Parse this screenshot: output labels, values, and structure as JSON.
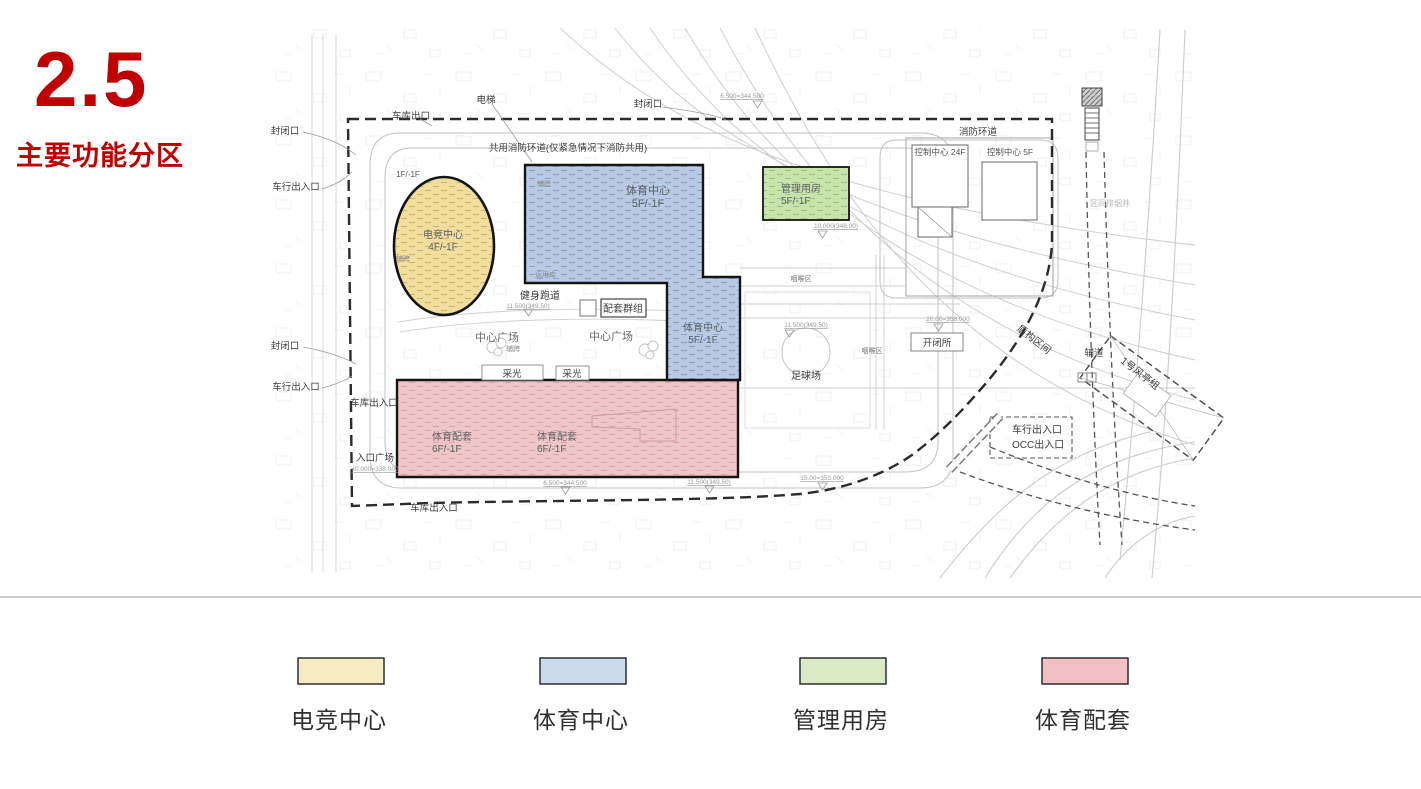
{
  "slide": {
    "number": "2.5",
    "title": "主要功能分区",
    "accent_color": "#C00000"
  },
  "plan": {
    "labels": {
      "garage_exit": "车库出口",
      "elevator": "电梯",
      "closed_opening": "封闭口",
      "shared_fire_ring": "共用消防环道(仅紧急情况下消防共用)",
      "floors_1f": "1F/-1F",
      "vehicle_entrance": "车行出入口",
      "garage_entrance": "车库出入口",
      "entrance_plaza": "入口广场",
      "fire_ring": "消防环道",
      "control_center_24f": "控制中心  24F",
      "control_center_5f": "控制中心  5F",
      "fitness_track": "健身跑道",
      "support_cluster": "配套群组",
      "central_plaza": "中心广场",
      "aux_span": "辅跨",
      "operation_depot": "运用库",
      "daylight": "采光",
      "football_field": "足球场",
      "throat_area": "咽喉区",
      "switch_station": "开闭所",
      "shield_section": "盾构区间",
      "aux_road": "辅道",
      "wind_pavilion": "1号风亭组",
      "occ_entrance": "OCC出入口",
      "smoke_shaft": "区间排烟井"
    },
    "elevations": {
      "e6500": "6.500=344.500",
      "e10000": "10.000(348.00)",
      "e11500": "11.500(349.50)",
      "e20000": "20.00=358.000",
      "e0000": "±0.000=338.000",
      "e15000": "15.00=353.000"
    },
    "zones": {
      "esports": {
        "name": "电竞中心",
        "floors": "4F/-1F",
        "fill": "#F1DD9E"
      },
      "sports": {
        "name": "体育中心",
        "floors": "5F/-1F",
        "fill": "#B9CAE4"
      },
      "management": {
        "name": "管理用房",
        "floors": "5F/-1F",
        "fill": "#C8E3AC"
      },
      "support": {
        "name": "体育配套",
        "floors": "6F/-1F",
        "fill": "#EFC6C7"
      }
    }
  },
  "legend": {
    "items": [
      {
        "label": "电竞中心",
        "color": "#F6ECC3"
      },
      {
        "label": "体育中心",
        "color": "#CBD9ED"
      },
      {
        "label": "管理用房",
        "color": "#D8EBC6"
      },
      {
        "label": "体育配套",
        "color": "#F0C0C3"
      }
    ]
  }
}
